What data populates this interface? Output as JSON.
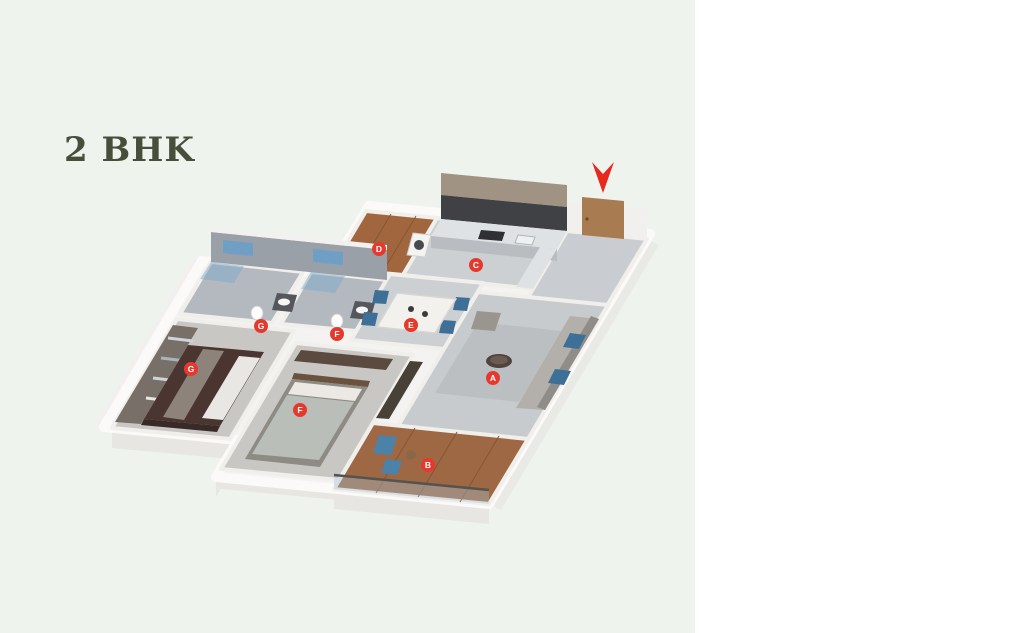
{
  "page": {
    "title": "2 BHK"
  },
  "legend": {
    "left_items": [
      {
        "label": "Living",
        "badge": "A"
      },
      {
        "label": "Terrace",
        "badge": "B"
      },
      {
        "label": "Kitchen",
        "badge": "C"
      },
      {
        "label": "Dry Terrace",
        "badge": "D"
      },
      {
        "label": "Dining",
        "badge": "E"
      }
    ],
    "right_items": [
      {
        "label": "Bedroom 1",
        "sublabel": "Bath & WC 1",
        "badge": "F"
      },
      {
        "label": "Bedroom 2",
        "sublabel": "Bath & WC 2",
        "badge": "G"
      }
    ]
  },
  "area_table": {
    "headers": [
      "carpet",
      "balcony",
      "total usable area"
    ],
    "values": [
      "731",
      "94",
      "825"
    ]
  },
  "plan3d": {
    "markers": [
      "A",
      "B",
      "C",
      "D",
      "E",
      "F",
      "F",
      "G",
      "G"
    ]
  },
  "colors": {
    "badge_red": "#e6392e",
    "arrow_red": "#e8281e",
    "table_header_bg": "#d8e9ee",
    "title_color": "#474f3a",
    "left_panel_bg": "#eff3ee"
  }
}
